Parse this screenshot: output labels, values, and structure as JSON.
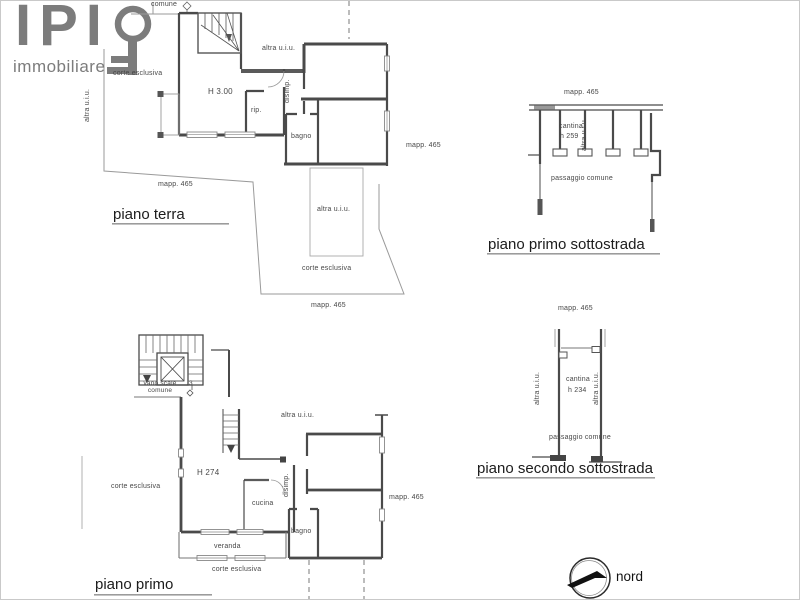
{
  "logo": {
    "name": "IPI",
    "tagline": "immobiliare"
  },
  "compass": {
    "label": "nord"
  },
  "floors": {
    "terra": {
      "title": "piano terra",
      "labels": {
        "comune": "comune",
        "corte_top": "corte esclusiva",
        "altra_left": "altra u.i.u.",
        "height": "H 3.00",
        "rip": "rip.",
        "disimp": "disimp.",
        "bagno": "bagno",
        "altra_mid": "altra u.i.u.",
        "mapp_right": "mapp. 465",
        "mapp_left": "mapp. 465",
        "altra_rect": "altra u.i.u.",
        "corte_bottom": "corte esclusiva",
        "mapp_bottom": "mapp. 465"
      }
    },
    "primo": {
      "title": "piano primo",
      "labels": {
        "vano_scale": "vano scale\ncomune",
        "stair_num": "3",
        "altra": "altra u.i.u.",
        "height": "H 274",
        "corte_left": "corte esclusiva",
        "cucina": "cucina",
        "disimp": "disimp.",
        "bagno": "bagno",
        "veranda": "veranda",
        "corte_bottom": "corte esclusiva",
        "mapp": "mapp. 465"
      }
    },
    "primo_sottostrada": {
      "title": "piano primo sottostrada",
      "labels": {
        "mapp": "mapp. 465",
        "cantina": "cantina",
        "cantina_h": "h 259",
        "altra": "altra u.i.u.",
        "passaggio": "passaggio comune"
      }
    },
    "secondo_sottostrada": {
      "title": "piano secondo sottostrada",
      "labels": {
        "mapp": "mapp. 465",
        "cantina": "cantina",
        "cantina_h": "h 234",
        "altra_left": "altra u.i.u.",
        "altra_right": "altra u.i.u.",
        "passaggio": "passaggio comune"
      }
    }
  }
}
